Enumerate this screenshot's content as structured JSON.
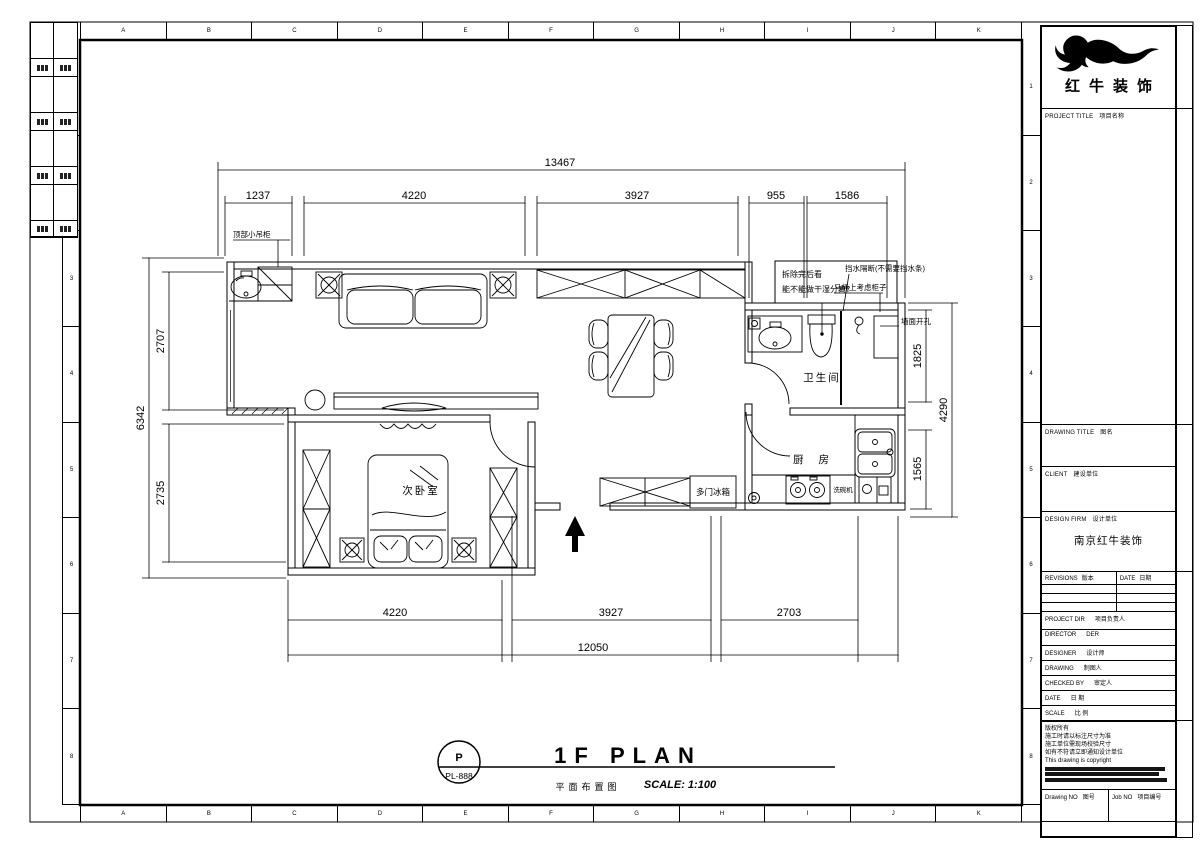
{
  "sheet": {
    "ruler_letters": [
      "A",
      "B",
      "C",
      "D",
      "E",
      "F",
      "G",
      "H",
      "I",
      "J",
      "K"
    ],
    "ruler_numbers": [
      "1",
      "2",
      "3",
      "4",
      "5",
      "6",
      "7",
      "8"
    ]
  },
  "title_block": {
    "company_name": "红牛装饰",
    "design_firm_value": "南京红牛装饰",
    "fields": {
      "project_title": {
        "en": "PROJECT TITLE",
        "cn": "项目名称"
      },
      "drawing_title": {
        "en": "DRAWING TITLE",
        "cn": "图名"
      },
      "client": {
        "en": "CLIENT",
        "cn": "建设单位"
      },
      "design_firm": {
        "en": "DESIGN FIRM",
        "cn": "设计单位"
      },
      "revisions": {
        "en": "REVISIONS",
        "cn": "版本"
      },
      "date_col": {
        "en": "DATE",
        "cn": "日期"
      },
      "project_dir": {
        "en": "PROJECT DIR",
        "cn": "项目负责人"
      },
      "director": {
        "en": "DIRECTOR",
        "cn": "DER"
      },
      "designer": {
        "en": "DESIGNER",
        "cn": "设计师"
      },
      "drawing": {
        "en": "DRAWING",
        "cn": "制图人"
      },
      "checked_by": {
        "en": "CHECKED BY",
        "cn": "审定人"
      },
      "date_row": {
        "en": "DATE",
        "cn": "日 期"
      },
      "scale_row": {
        "en": "SCALE",
        "cn": "比 例"
      },
      "drawing_no": {
        "en": "Drawing NO",
        "cn": "图号"
      },
      "job_no": {
        "en": "Job NO",
        "cn": "项目编号"
      }
    },
    "notes": [
      "版权所有",
      "施工时请以标注尺寸为准",
      "施工单位需现场校验尺寸",
      "如有不符请立即通知设计单位",
      "This drawing is copyright"
    ]
  },
  "plan": {
    "rooms": {
      "bathroom": "卫生间",
      "kitchen": "厨 房",
      "bedroom": "次卧室"
    },
    "labels": {
      "top_cabinet": "顶部小吊柜",
      "demolition_note_1": "拆除完后看",
      "demolition_note_2": "能不能做干湿分离？",
      "water_barrier": "挡水隔断(不需要挡水条)",
      "toilet_cabinet": "马桶上考虑柜子",
      "wall_hole": "墙面开孔",
      "fridge": "多门冰箱",
      "dishwasher": "洗碗机"
    },
    "dimensions": {
      "top_total": "13467",
      "top_segments": [
        "1237",
        "4220",
        "3927",
        "955",
        "1586"
      ],
      "bottom_total": "12050",
      "bottom_segments": [
        "4220",
        "3927",
        "2703"
      ],
      "left_total": "6342",
      "left_segments": [
        "2707",
        "2735"
      ],
      "right_total": "4290",
      "right_segments": [
        "1825",
        "1565"
      ]
    }
  },
  "footer": {
    "tag_letter": "P",
    "tag_number": "PL-888",
    "title_en": "1F PLAN",
    "title_cn": "平面布置图",
    "scale": "SCALE: 1:100"
  }
}
